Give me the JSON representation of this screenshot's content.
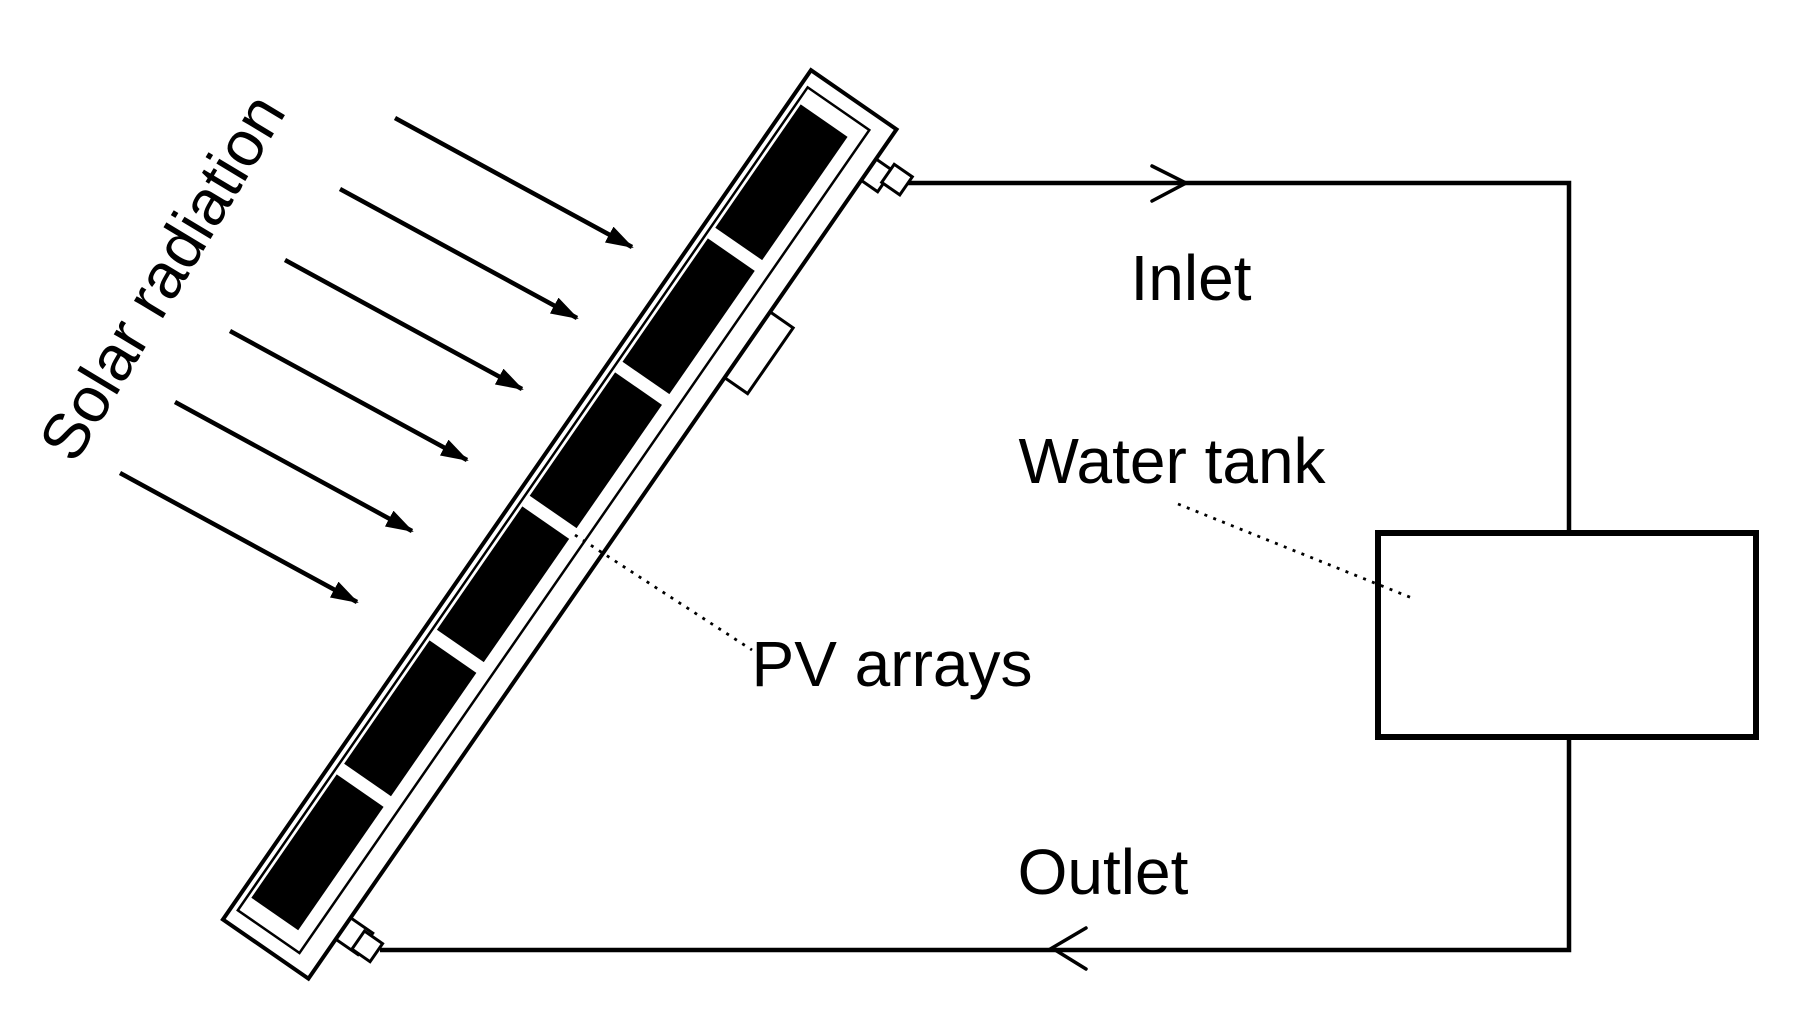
{
  "figure": {
    "type": "schematic-diagram",
    "background_color": "#ffffff",
    "line_color": "#000000",
    "pv_cell_color": "#000000",
    "labels": {
      "solar_radiation": "Solar radiation",
      "inlet": "Inlet",
      "water_tank": "Water tank",
      "pv_arrays": "PV arrays",
      "outlet": "Outlet"
    },
    "solar_arrow_count": 6,
    "pv_cell_count": 6
  }
}
